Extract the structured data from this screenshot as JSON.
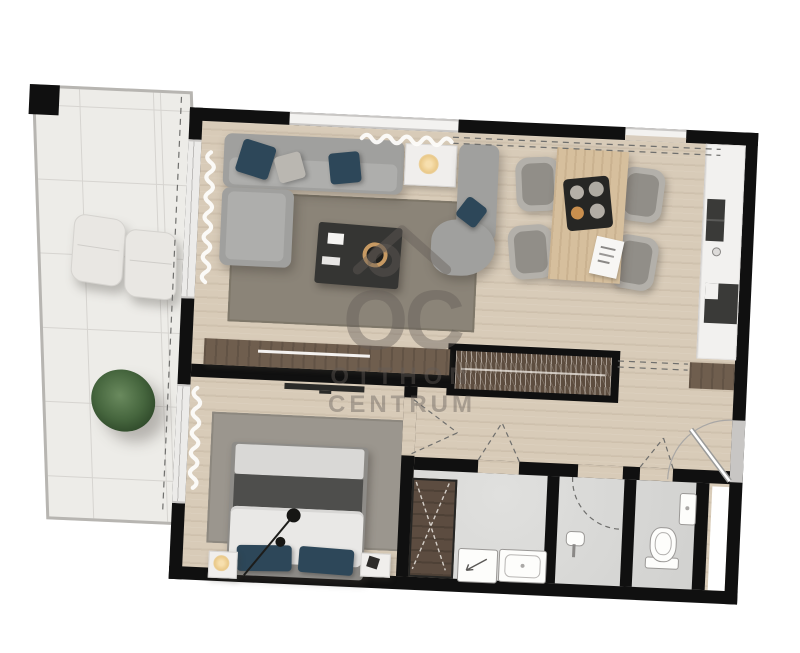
{
  "watermark": {
    "logo_text": "OC",
    "line1": "OTTHON",
    "line2": "CENTRUM"
  },
  "palette": {
    "wall": "#101010",
    "wood_floor": "#d8cbb8",
    "balcony_tile": "#edece8",
    "bath_tile": "#d6d6d4",
    "sofa_gray": "#a0a09e",
    "accent_pillow_blue": "#2d4759",
    "rug_living": "#8b8478",
    "rug_bedroom": "#9b968e",
    "furniture_wood_dark": "#6f5e4e",
    "dining_table_oak": "#d6bf9d",
    "plant_green": "#46663e",
    "watermark_gray": "rgba(100,94,88,0.42)"
  },
  "icons": {
    "washer_arrow": "diagonal-arrow",
    "wardrobe_hangers": "vertical-hatch",
    "cabinet_cross": "x-cross",
    "door_swing": "dashed-arc",
    "curtain": "white-squiggle",
    "pendant_lamp": "line-with-dots",
    "house_logo": "roof-and-circle"
  }
}
